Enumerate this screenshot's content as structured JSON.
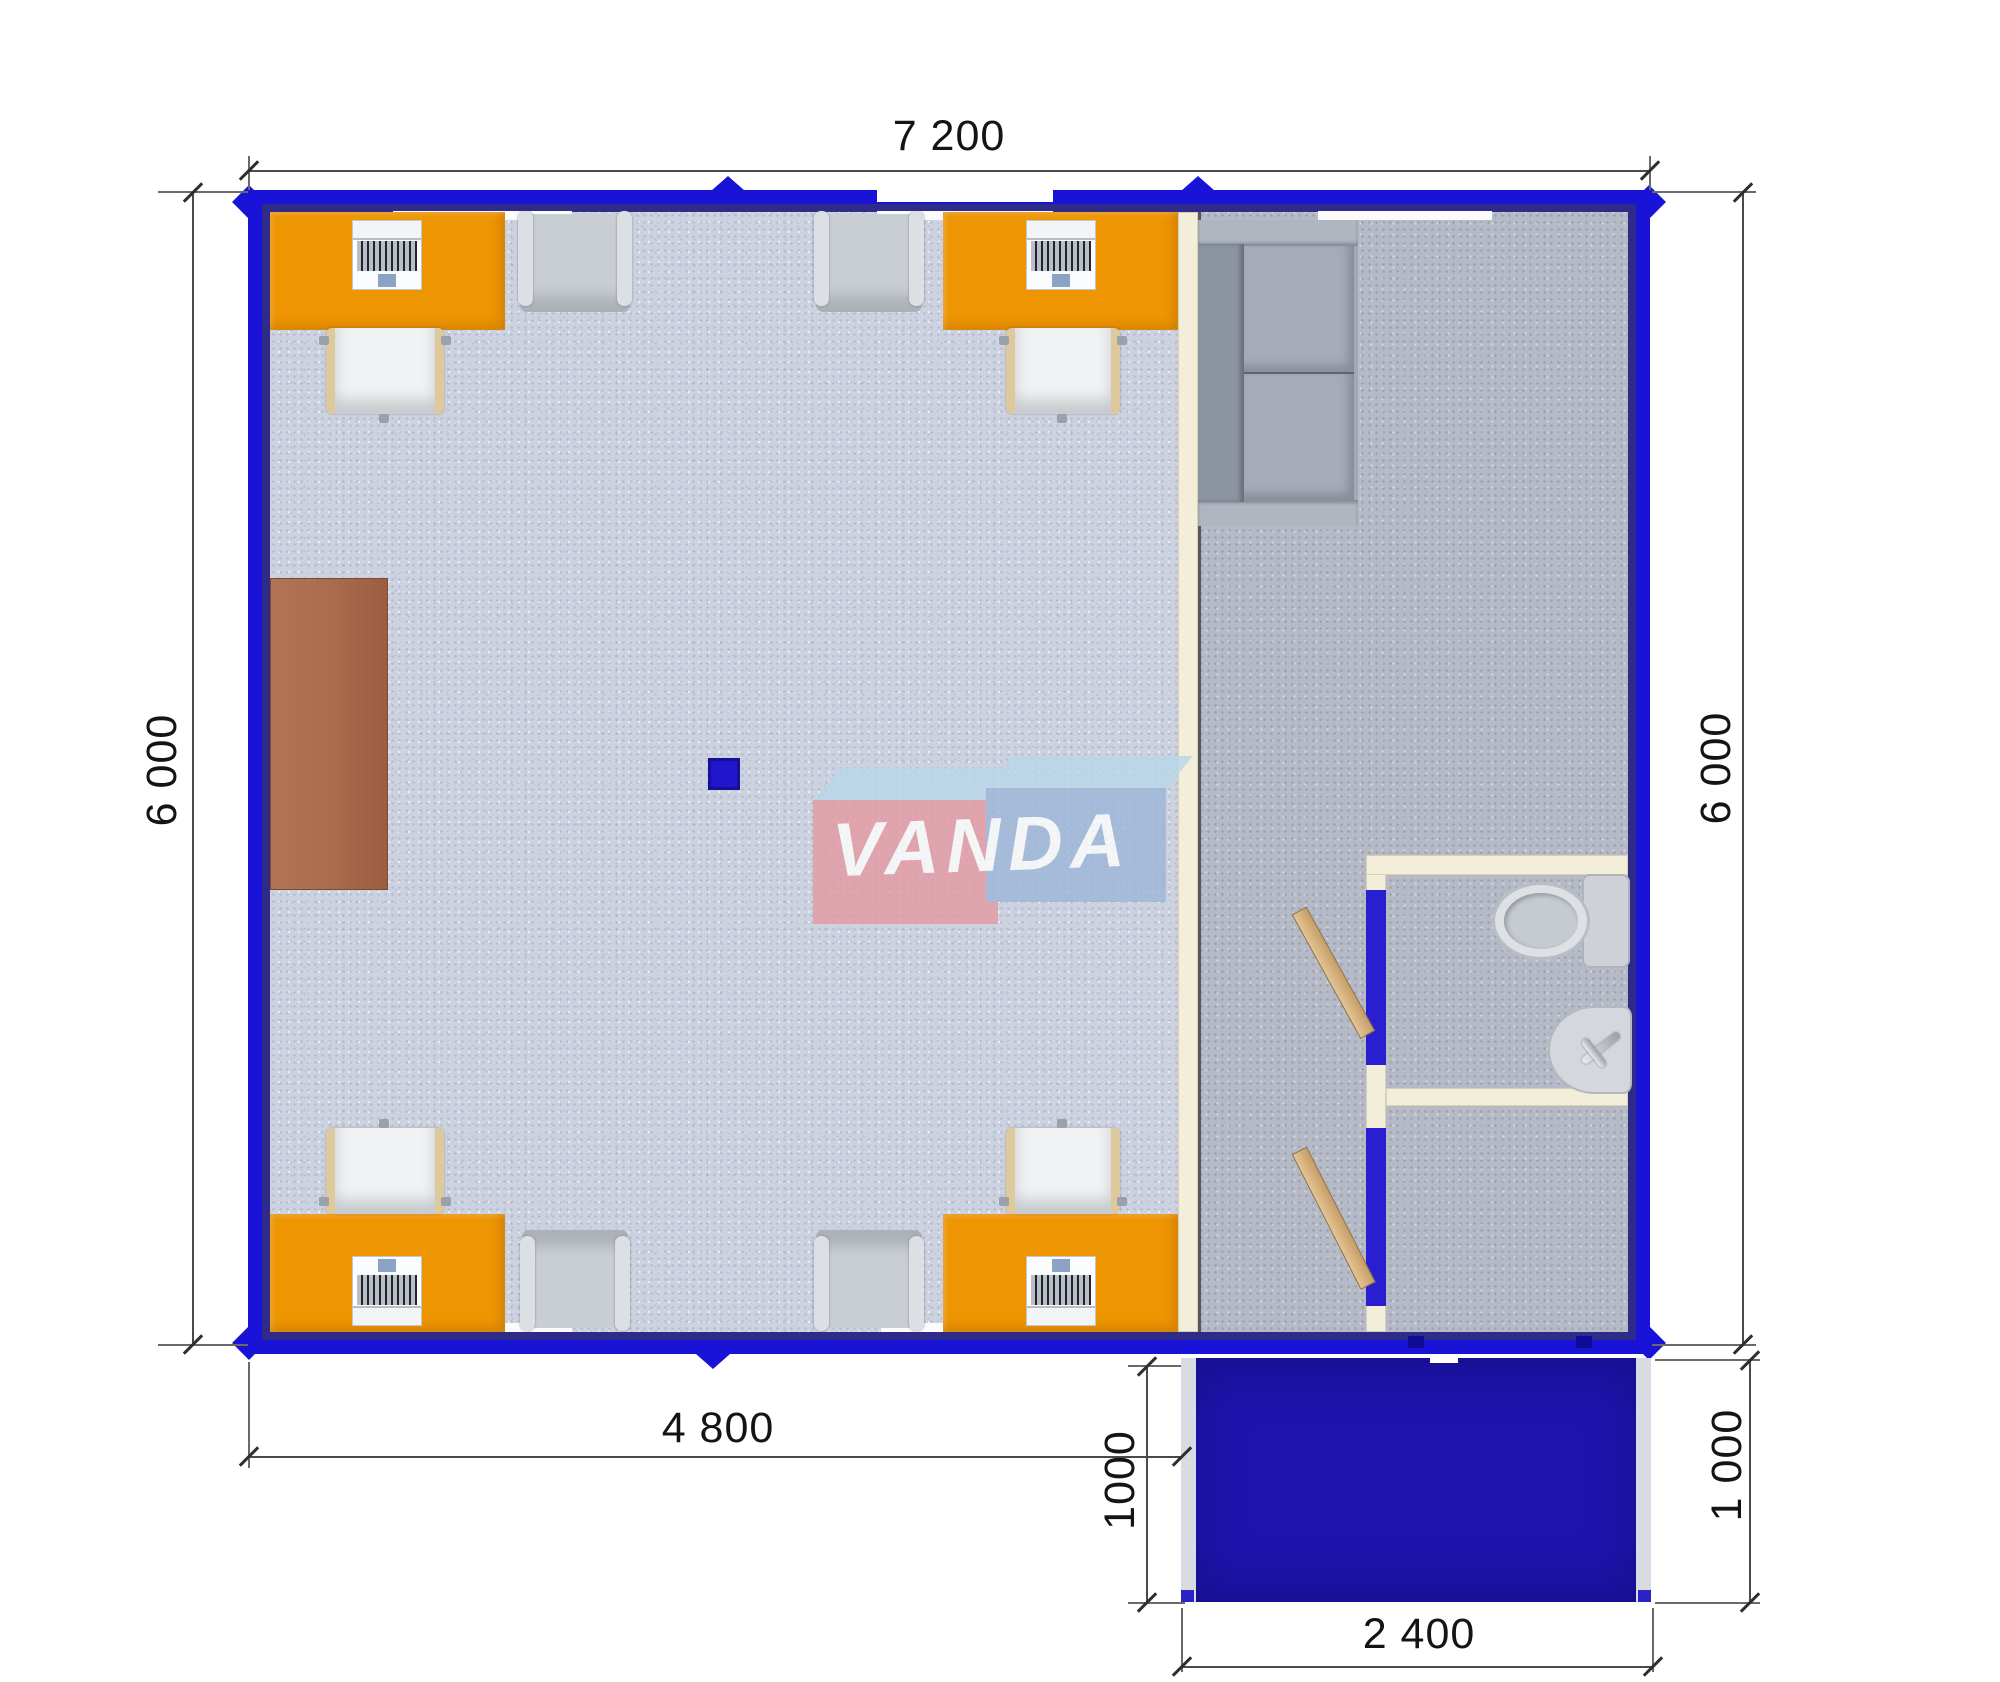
{
  "plan": {
    "logo_text": "VANDA",
    "dimensions": {
      "top": "7 200",
      "left": "6 000",
      "right": "6 000",
      "office_width": "4 800",
      "porch_depth_left": "1000",
      "porch_depth_right": "1 000",
      "porch_width": "2 400"
    },
    "colors": {
      "wall_blue": "#1813d6",
      "wall_inner_navy": "#2e2c88",
      "porch_blue": "#1d14ae",
      "porch_rail": "#d9dbe2",
      "desk_orange": "#ee9502",
      "cabinet_brown": "#aa6a4c",
      "partition_cream": "#f3eeda",
      "floor_office": "#cdd2e0",
      "floor_right": "#b6bac6",
      "sofa_gray": "#a2a9b5",
      "armchair_gray": "#c9cdd4",
      "chair_white": "#f0f2f4",
      "chair_wood": "#ddc99b",
      "door_wood": "#d7b383",
      "logo_pink": "#e49ba4",
      "logo_blue": "#9db7d8",
      "logo_top": "#b9d8ea",
      "dim_line": "#4a4a4a",
      "dim_text": "#141414"
    },
    "furniture": [
      "office desk",
      "laptop",
      "office chair",
      "armchair",
      "sofa",
      "cabinet",
      "support column",
      "toilet",
      "sink",
      "wood door",
      "entrance porch"
    ]
  }
}
